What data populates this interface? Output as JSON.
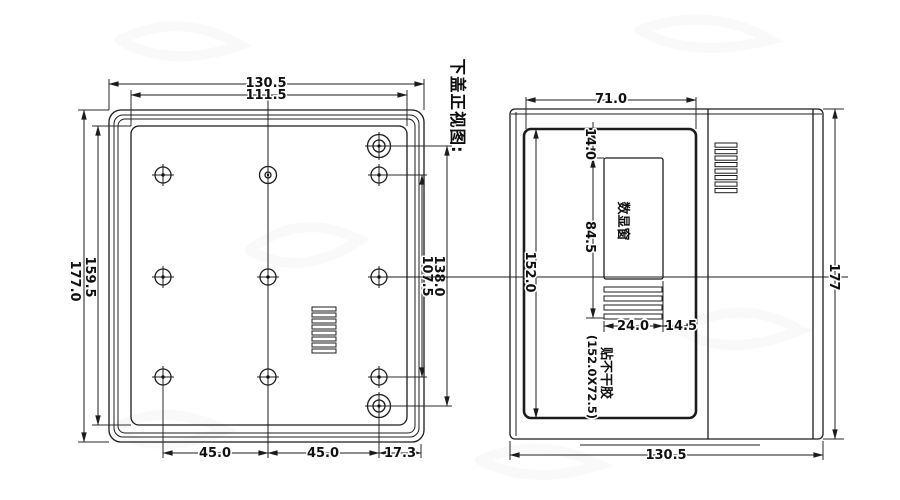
{
  "drawing": {
    "title": "下盖正视图:",
    "left_view": {
      "dim_top_outer": "130.5",
      "dim_top_inner": "111.5",
      "dim_left_outer": "177.0",
      "dim_left_inner": "159.5",
      "dim_right_outer": "138.0",
      "dim_right_inner": "107.5",
      "dim_bottom_left": "45.0",
      "dim_bottom_mid": "45.0",
      "dim_bottom_right": "17.3"
    },
    "right_view": {
      "dim_top_width": "71.0",
      "dim_window_offset": "14.0",
      "dim_window_height": "84.5",
      "dim_panel_height": "152.0",
      "dim_overall_height": "177",
      "dim_window_width": "24.0",
      "dim_side_margin": "14.5",
      "dim_bottom_width": "130.5",
      "label_display_window": "数显窗",
      "label_sticker_line1": "贴不干胶",
      "label_sticker_line2": "(152.0X72.5)"
    },
    "line_color": "#1c1c1c",
    "background_color": "#ffffff"
  }
}
